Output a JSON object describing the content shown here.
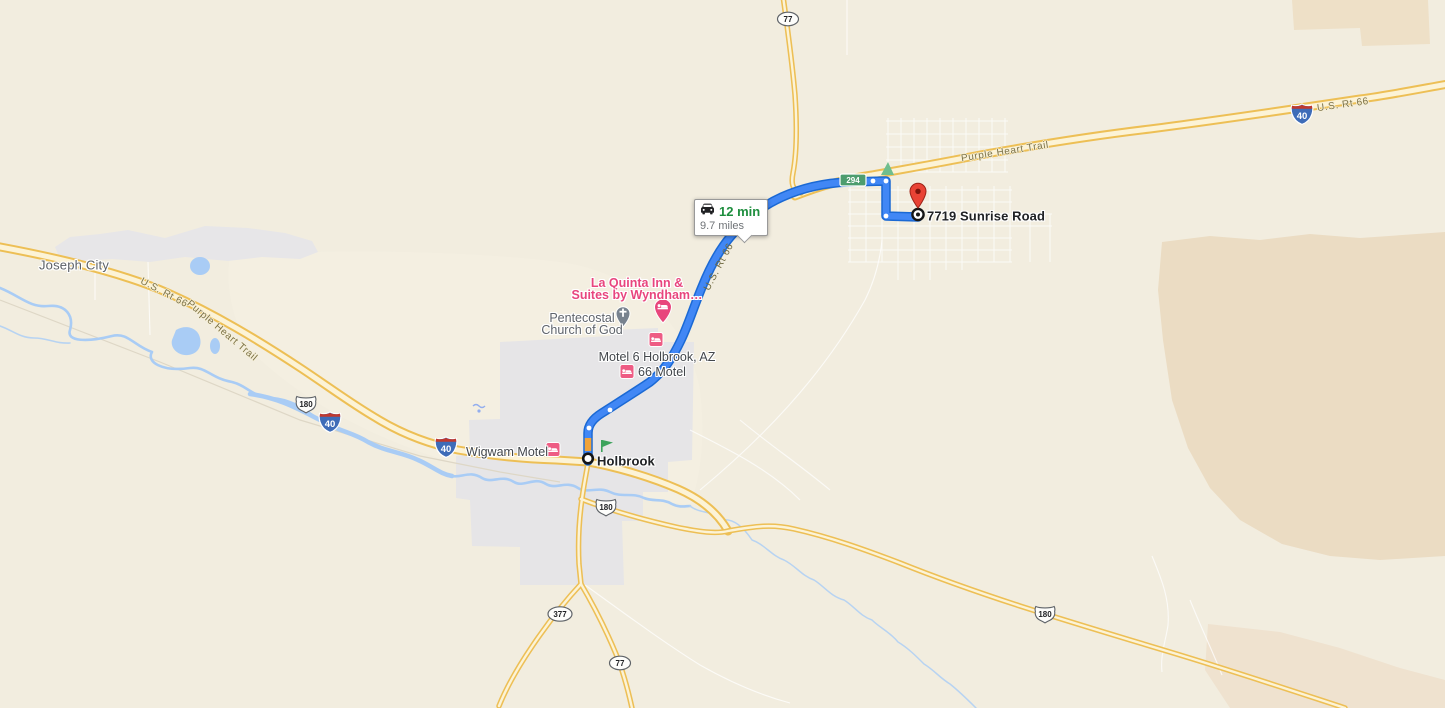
{
  "route": {
    "tooltip": {
      "duration": "12 min",
      "distance": "9.7 miles"
    },
    "origin": {
      "label": "Holbrook"
    },
    "destination": {
      "label": "7719 Sunrise Road"
    }
  },
  "places": {
    "city": "Joseph City",
    "la_quinta": {
      "line1": "La Quinta Inn &",
      "line2": "Suites by Wyndham…"
    },
    "church": {
      "line1": "Pentecostal",
      "line2": "Church of God"
    },
    "motel6": "Motel 6 Holbrook, AZ",
    "motel_66": "66 Motel",
    "wigwam": "Wigwam Motel"
  },
  "road_labels": {
    "us66": "U.S. Rt 66",
    "purple_heart": "Purple Heart Trail"
  },
  "shields": {
    "interstate_40": "40",
    "us_180": "180",
    "state_377": "377",
    "state_77": "77",
    "state_294": "294"
  },
  "colors": {
    "route_blue": "#4187f5",
    "route_casing": "#1b69d4",
    "traffic_orange": "#f0a33a",
    "highway_yellow": "#edbf55",
    "water_blue": "#a9ccf5",
    "urban_gray": "#e6e5e7",
    "hotel_pink": "#e8457e",
    "duration_green": "#1e8e3e",
    "pin_red": "#e94335",
    "shield_green": "#4d9d6f",
    "background_tan": "#f2eddf"
  }
}
